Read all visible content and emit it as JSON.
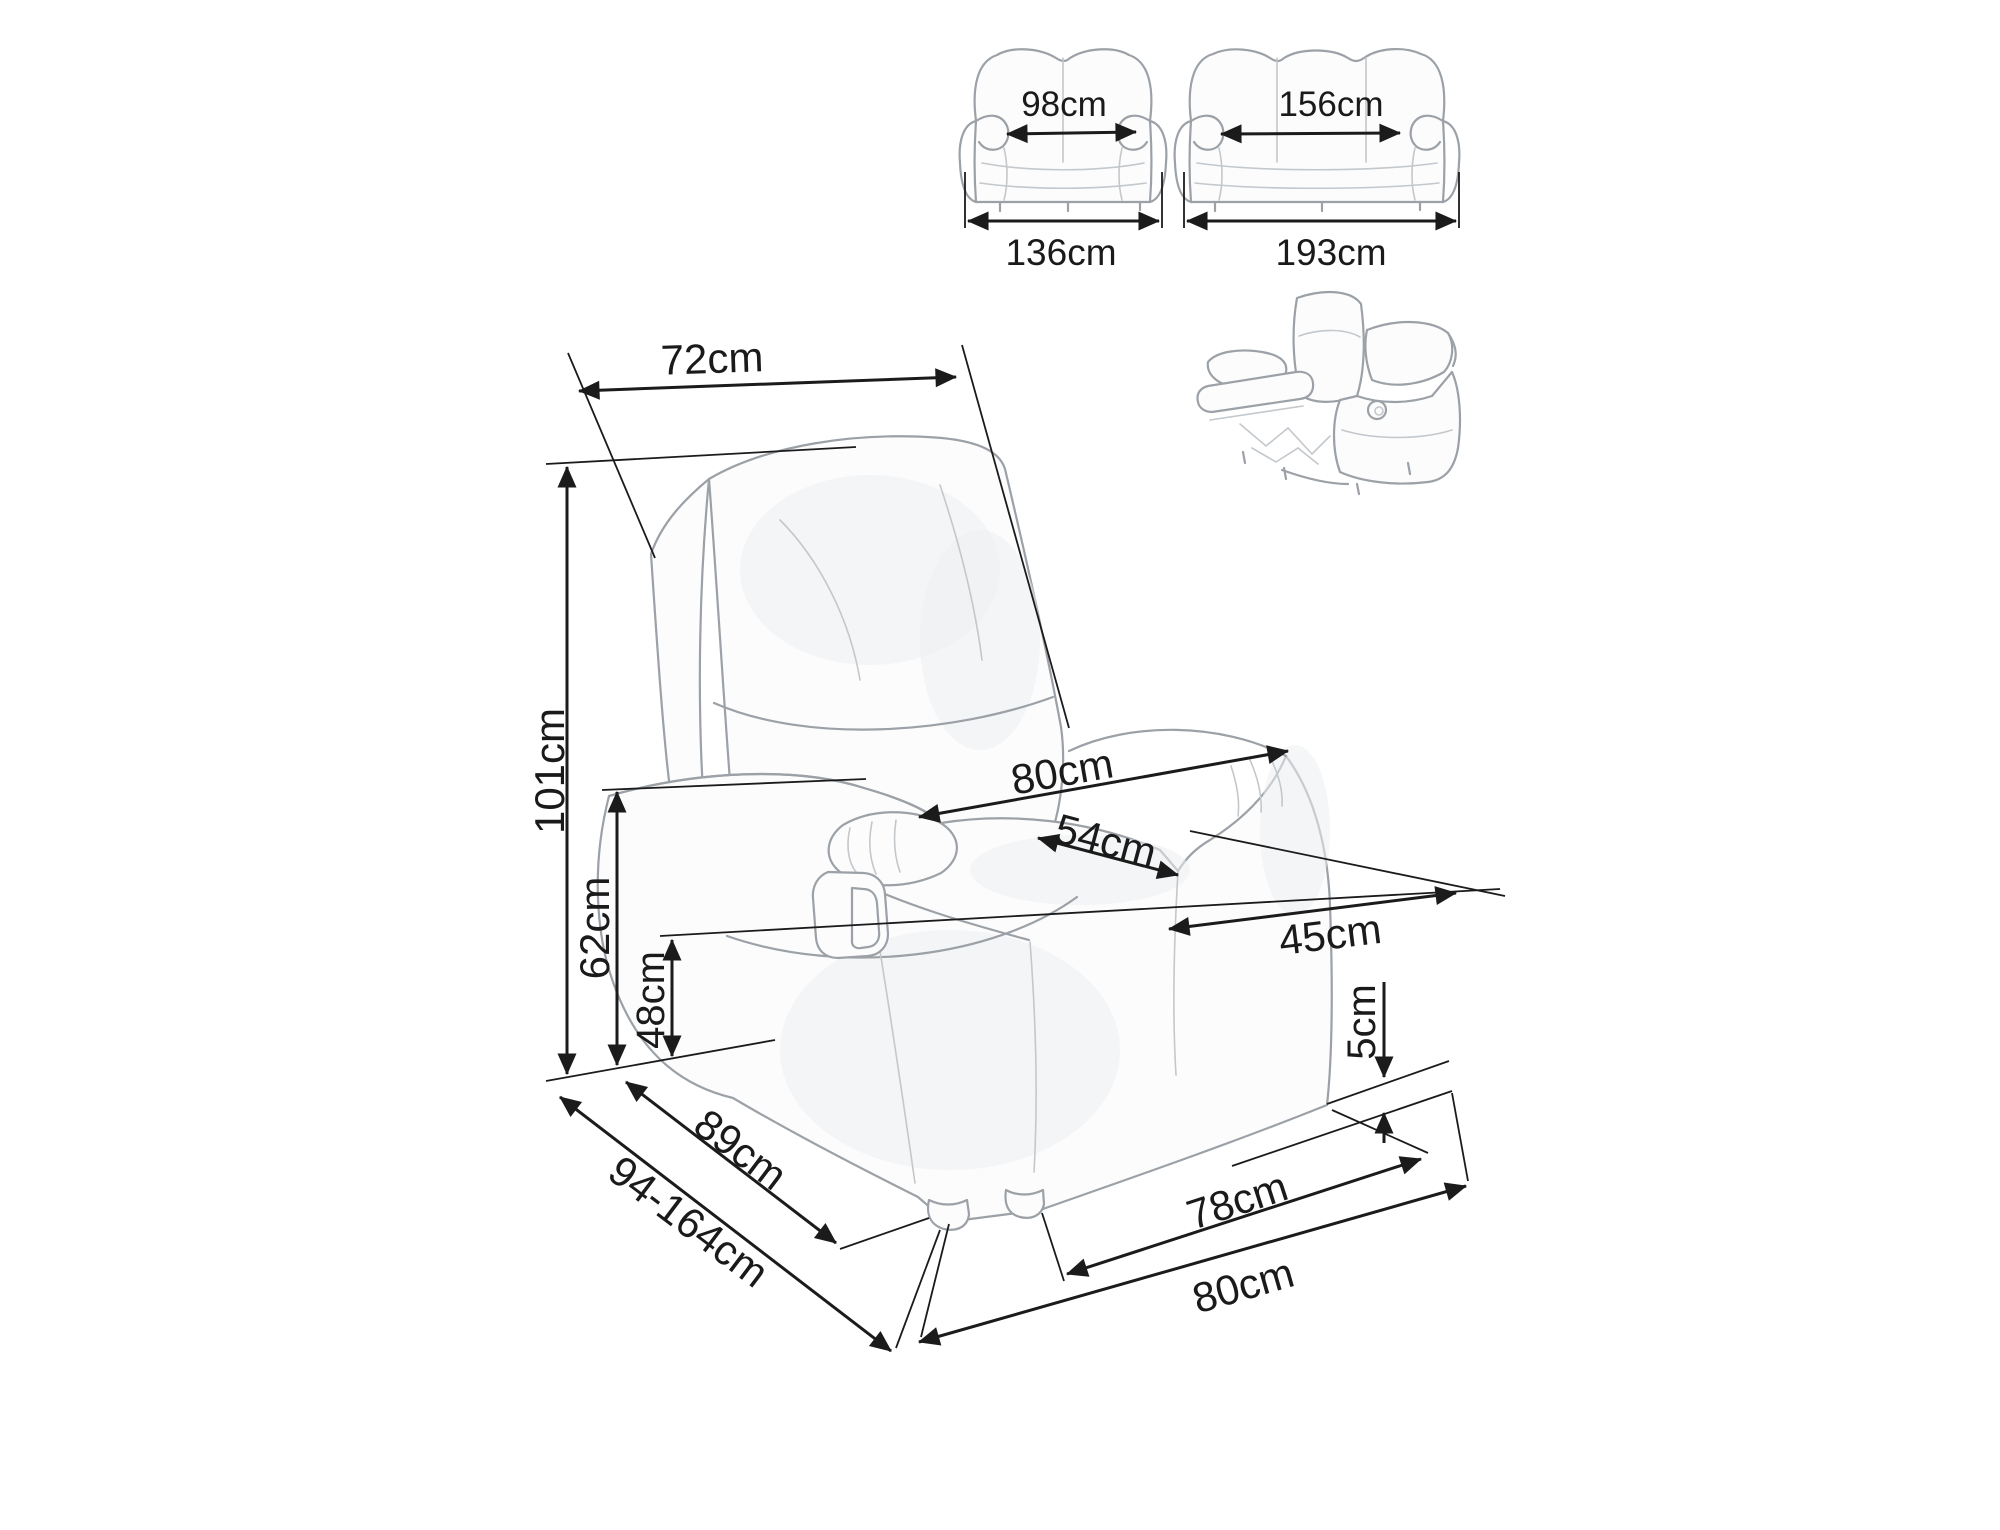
{
  "colors": {
    "background": "#ffffff",
    "dimension_line": "#1b1b1b",
    "sketch_line": "#9ba1a6",
    "label_text": "#1a1a1a"
  },
  "sofas": {
    "two_seater": {
      "inner_width": "98cm",
      "overall_width": "136cm"
    },
    "three_seater": {
      "inner_width": "156cm",
      "overall_width": "193cm"
    }
  },
  "armchair": {
    "backrest_width": "72cm",
    "overall_height": "101cm",
    "armrest_height": "62cm",
    "seat_height": "48cm",
    "overall_width": "80cm",
    "seat_width": "54cm",
    "seat_depth": "45cm",
    "ground_clearance": "5cm",
    "base_depth": "78cm",
    "overall_depth": "80cm",
    "side_depth": "89cm",
    "depth_range_reclined": "94-164cm"
  }
}
